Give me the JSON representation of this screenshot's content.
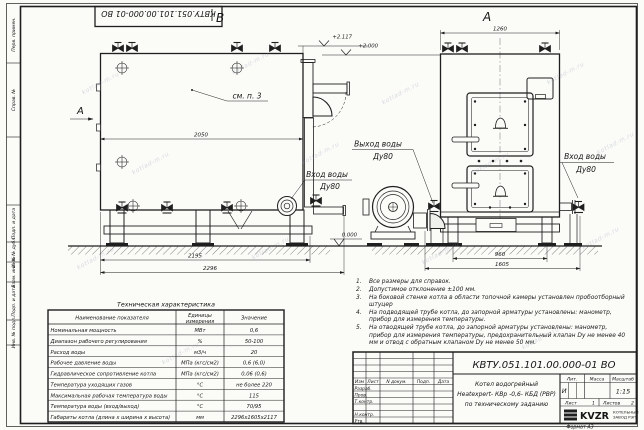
{
  "stamp": {
    "designation": "КВТУ.051.101.00.000-01  ВО"
  },
  "margin": {
    "labels": [
      "Перв. примен.",
      "Справ. №",
      "Подп. и дата",
      "Инв. № дубл.",
      "Взам. инв. №",
      "Подп. и дата",
      "Инв. № подл."
    ]
  },
  "views": {
    "b_label": "В",
    "a_label": "А",
    "section_label": "А",
    "see_note": "см. п. 3",
    "dim_b_mid": "2050",
    "dim_b_inner": "2195",
    "dim_b_outer": "2296",
    "dim_a_top": "1260",
    "dim_a_inner": "960",
    "dim_a_outer": "1605",
    "elev_top": "+2.117",
    "elev_mid": "+2.000",
    "elev_zero": "0.000",
    "outlet_label": "Выход воды",
    "outlet_dn": "Ду80",
    "inlet_label": "Вход воды",
    "inlet_dn": "Ду80",
    "inlet_b_label": "Вход воды",
    "inlet_b_dn": "Ду80"
  },
  "notes": {
    "items": [
      {
        "num": "1.",
        "text": "Все размеры для справок."
      },
      {
        "num": "2.",
        "text": "Допустимое отклонение ±100 мм."
      },
      {
        "num": "3.",
        "text": "На боковой стенке котла в области топочной камеры установлен пробоотборный штуцер"
      },
      {
        "num": "4.",
        "text": "На подводящей трубе котла, до запорной арматуры установлены: манометр, прибор для измерения температуры."
      },
      {
        "num": "5.",
        "text": "На отводящей трубе котла, до запорной арматуры установлены: манометр, прибор для измерения температуры, предохранительный клапан Dу не менее 40 мм и отвод с обратным клапаном Dу не менее 50 мм."
      }
    ]
  },
  "tech": {
    "title": "Техническая характеристика",
    "col_name": "Наименование показателя",
    "col_units_1": "Единицы",
    "col_units_2": "измерения",
    "col_value": "Значение",
    "rows": [
      [
        "Номинальная мощность",
        "МВт",
        "0,6"
      ],
      [
        "Диапазон рабочего регулирования",
        "%",
        "50-100"
      ],
      [
        "Расход воды",
        "м3/ч",
        "20"
      ],
      [
        "Рабочее давление воды",
        "МПа (кгс/см2)",
        "0,6 (6,0)"
      ],
      [
        "Гидравлическое сопротивление котла",
        "МПа (кгс/см2)",
        "0,06 (0,6)"
      ],
      [
        "Температура уходящих газов",
        "°С",
        "не более 220"
      ],
      [
        "Максимальная рабочая температура воды",
        "°С",
        "115"
      ],
      [
        "Температура воды (вход/выход)",
        "°С",
        "70/95"
      ],
      [
        "Габариты котла (длина х ширина х высота)",
        "мм",
        "2296х1605х2117"
      ]
    ]
  },
  "tb": {
    "designation": "КВТУ.051.101.00.000-01  ВО",
    "cols": [
      "Изм",
      "Лист",
      "N докум.",
      "Подп.",
      "Дата"
    ],
    "sig": [
      "Разраб.",
      "Пров.",
      "Т.контр.",
      "Н.контр.",
      "Утв."
    ],
    "name1": "Котел водогрейный",
    "name2": "Heatexpert- КВр -0,6- КБД (РВР)",
    "name3": "по техническому заданию",
    "lit_h": "Лит.",
    "mass_h": "Масса",
    "scale_h": "Масштаб",
    "lit": "И",
    "scale": "1:15",
    "sheet_h": "Лист",
    "sheet": "1",
    "sheets_h": "Листов",
    "sheets": "2",
    "logo": "KVZR",
    "logo_s1": "КОТЕЛЬНЫЙ",
    "logo_s2": "ЗАВОД РЭП",
    "format": "Формат  А3"
  },
  "watermark": "kotlad-m.ru"
}
